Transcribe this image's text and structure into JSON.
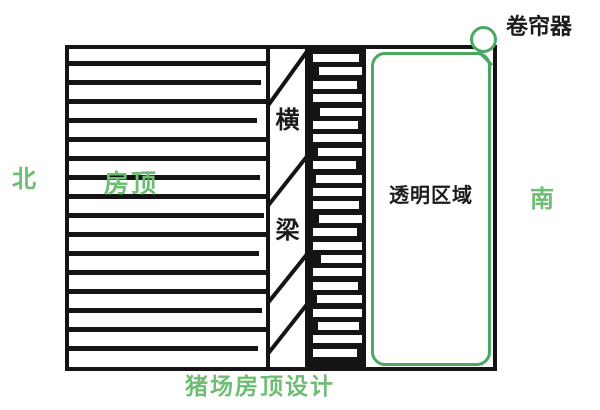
{
  "title": "猪场房顶设计",
  "compass": {
    "north": "北",
    "south": "南"
  },
  "diagram": {
    "roof_label": "房顶",
    "beam_label_top": "横",
    "beam_label_bottom": "梁",
    "transparent_area_label": "透明区域",
    "roller_shutter_label": "卷帘器"
  },
  "colors": {
    "line_black": "#141414",
    "green_line": "#4ca762",
    "green_text": "#6dbd72"
  }
}
